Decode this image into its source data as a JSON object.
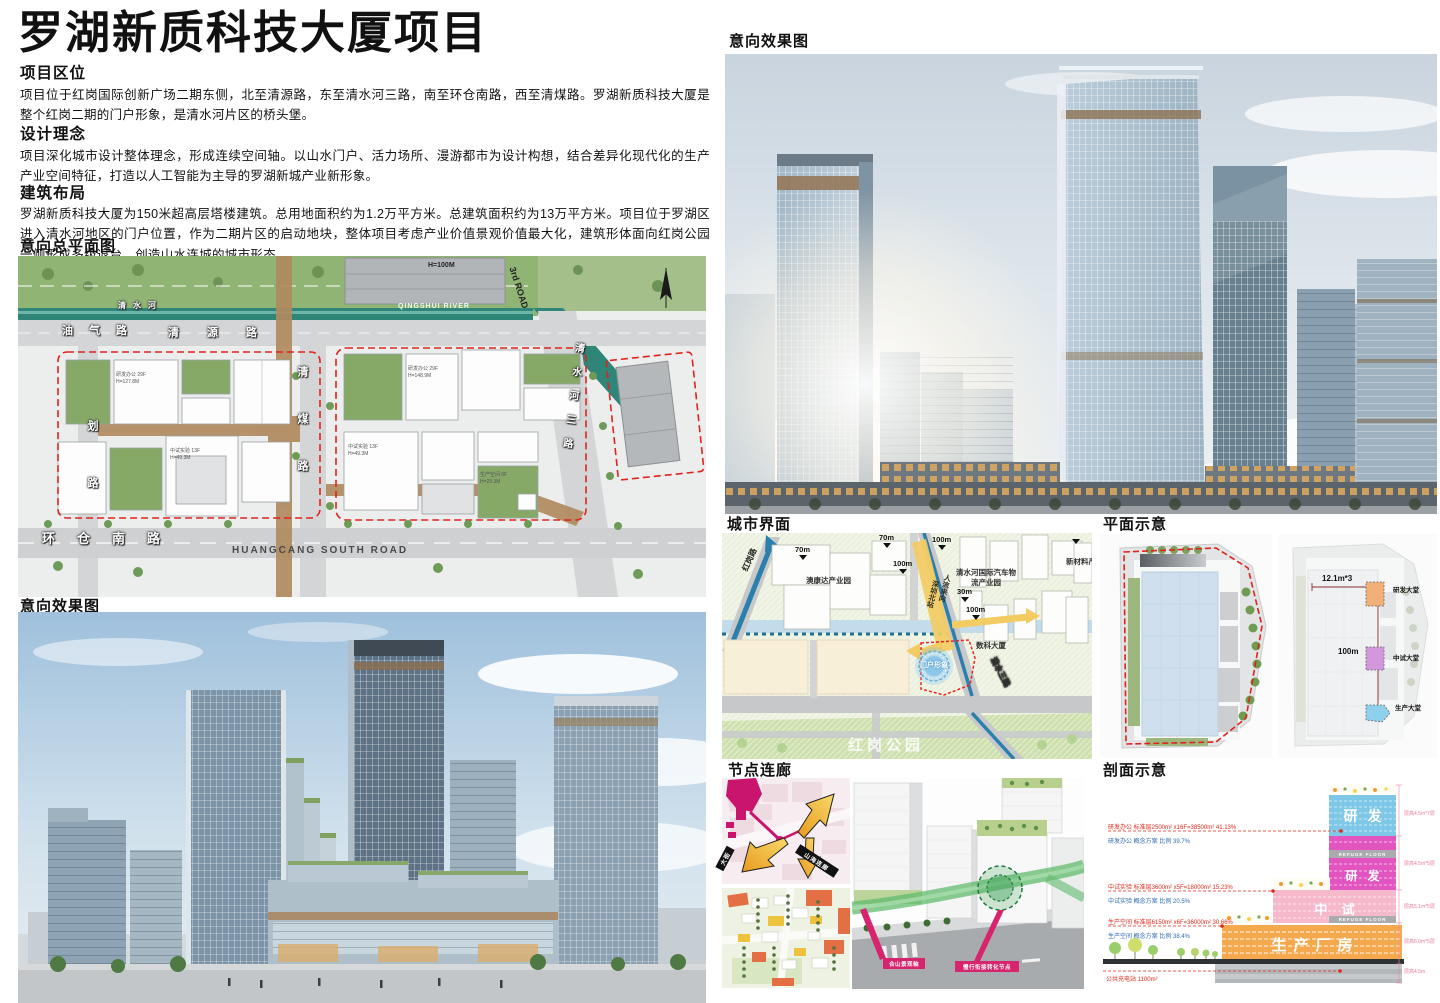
{
  "title": "罗湖新质科技大厦项目",
  "sections": {
    "location_heading": "项目区位",
    "location_body": "项目位于红岗国际创新广场二期东侧，北至清源路，东至清水河三路，南至环仓南路，西至清煤路。罗湖新质科技大厦是整个红岗二期的门户形象，是清水河片区的桥头堡。",
    "concept_heading": "设计理念",
    "concept_body": "项目深化城市设计整体理念，形成连续空间轴。以山水门户、活力场所、漫游都市为设计构想，结合差异化现代化的生产产业空间特征，打造以人工智能为主导的罗湖新城产业新形象。",
    "massing_heading": "建筑布局",
    "massing_body": "罗湖新质科技大厦为150米超高层塔楼建筑。总用地面积约为1.2万平方米。总建筑面积约为13万平方米。项目位于罗湖区进入清水河地区的门户位置，作为二期片区的启动地块，整体项目考虑产业价值景观价值最大化，建筑形体面向红岗公园一侧形成多级退台，创造山水连城的城市形态。"
  },
  "figure_headings": {
    "master_plan": "意向总平面图",
    "render_left": "意向效果图",
    "render_right": "意向效果图",
    "city_interface": "城市界面",
    "plan_diagram": "平面示意",
    "node_corridor": "节点连廊",
    "section_diagram": "剖面示意"
  },
  "master_plan": {
    "river_cn": "清水河",
    "river_en": "QINGSHUI RIVER",
    "road_youqi": "油气路",
    "road_qingyuan": "清源路",
    "road_qingmei": "清煤路",
    "road_guihua": "划路",
    "road_qingshuihe3": "清水河三路",
    "road_3rd": "3rd ROAD",
    "road_huancang_cn": "环仓南路",
    "road_huancang_en": "HUANGCANG SOUTH ROAD",
    "bldg_h100": "H=100M",
    "lot_labels": [
      "研发办公 29F H=127.8M",
      "中试实验 13F H=49.3M",
      "研发办公 29F H=148.9M",
      "中试实验 13F H=49.3M",
      "生产空间 6F H=29.3M"
    ]
  },
  "city_interface": {
    "road_honggang": "红岗路",
    "aokangda": "澳康达产业园",
    "qsh_logistics": "清水河国际汽车物流产业园",
    "new_material": "新材料产业园",
    "shuke": "数科大厦",
    "flow_main": "人流来向",
    "flow_sub": "深圳北站",
    "gateway": "门户形象",
    "park": "红岗公园",
    "road_qingshui3": "清水三路",
    "m70a": "70m",
    "m70b": "70m",
    "m100a": "100m",
    "m100b": "100m",
    "m100c": "100m",
    "m30": "30m"
  },
  "plan_diagram": {
    "dim_w": "12.1m*3",
    "dim_h": "100m",
    "lobby_rd": "研发大堂",
    "lobby_pilot": "中试大堂",
    "lobby_prod": "生产大堂"
  },
  "node_corridor": {
    "banner_shanhai": "山海连廊",
    "banner_street": "大街",
    "tag_axis": "合山景观轴",
    "tag_node": "慢行衔接转化节点"
  },
  "section_diagram": {
    "zone_rd1": "研发",
    "zone_rd2": "研发",
    "zone_pilot": "中试",
    "zone_prod": "生产厂房",
    "refuge1": "REFUGE FLOOR",
    "refuge2": "REFUGE FLOOR",
    "red1": "研发办公 标准层2500m² x16F=38500m²  41.13%",
    "blue1": "研发办公 概念方案 比例 39.7%",
    "red2": "中试实验 标准层3600m² x5F=18000m²  15.23%",
    "blue2": "中试实验 概念方案 比例 20.5%",
    "red3": "生产空间 标准层6150m² x6F=36000m²  30.66%",
    "blue3": "生产空间 概念方案 比例 38.4%",
    "red4": "公共充电站 1100m²",
    "dim1": "层高4.5m*7层",
    "dim2": "层高4.5m*5层",
    "dim3": "层高5.1m*5层",
    "dim4": "层高6.0m*5层",
    "dim5": "层高4.5m"
  },
  "colors": {
    "boundary_red": "#e0231c",
    "magenta_tag": "#d6246e",
    "corridor_green": "#62bb6e",
    "flow_yellow": "#f2cb62",
    "river_blue": "#2b7fad",
    "sec_orange": "#f5a94e",
    "sec_pink": "#f6b8cb",
    "sec_magenta": "#e255c0",
    "sec_blue": "#7ec7e6"
  }
}
